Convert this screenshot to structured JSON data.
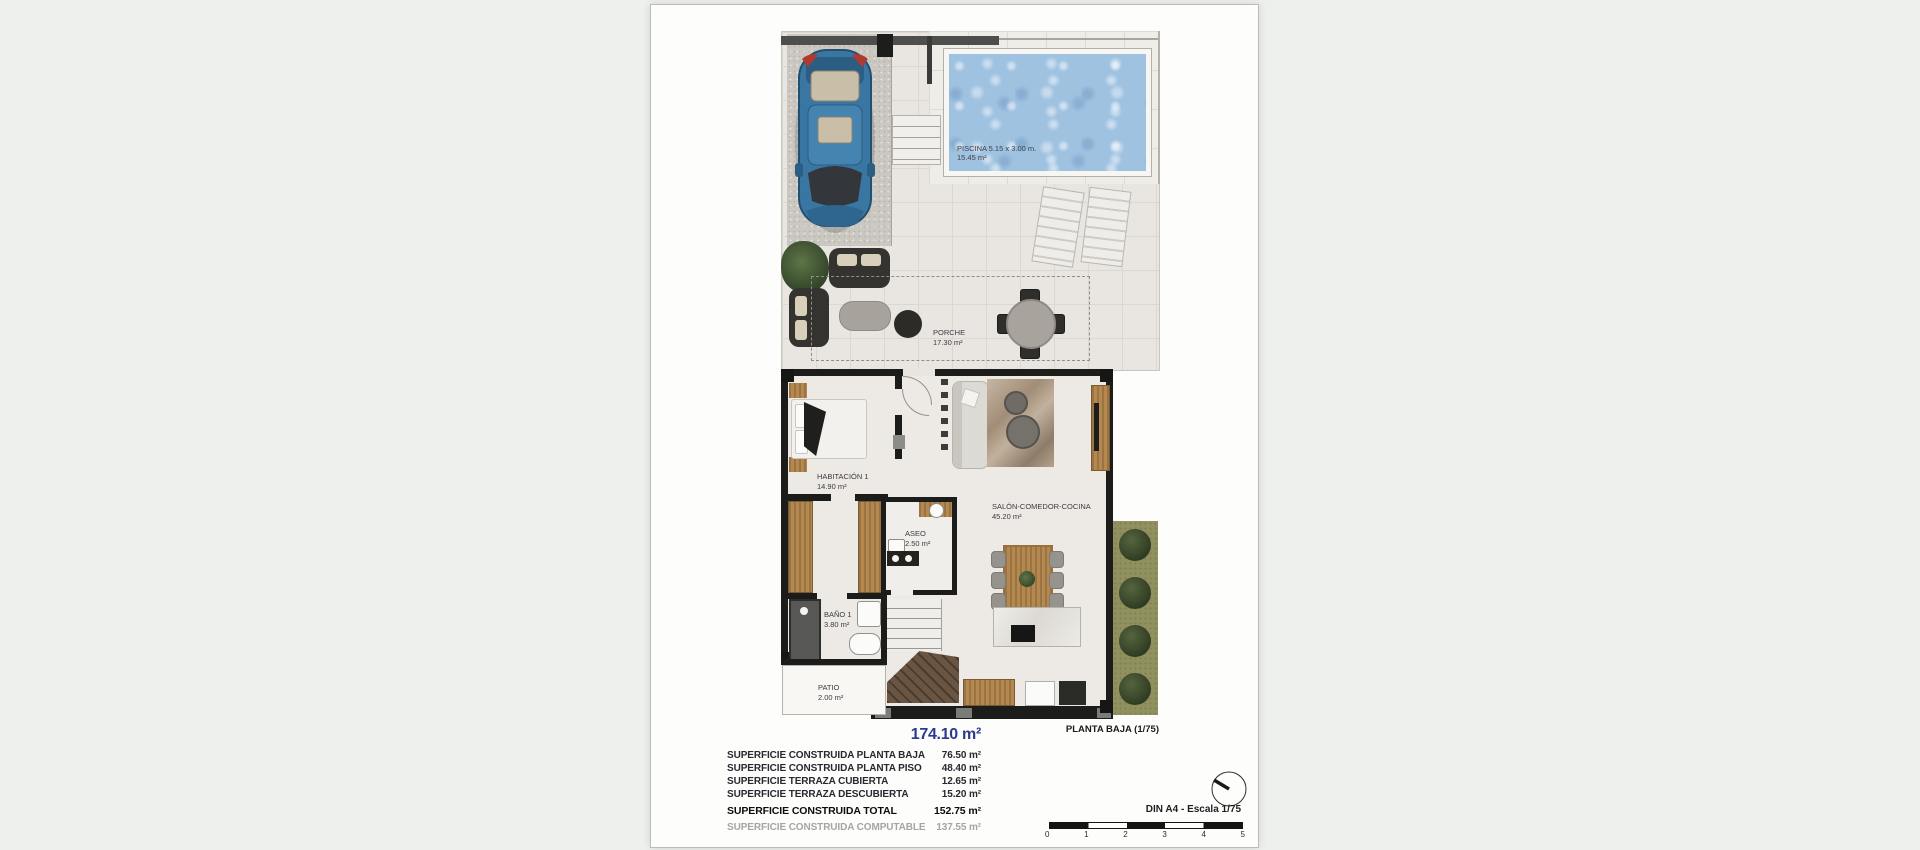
{
  "doc": {
    "plan_caption": "PLANTA BAJA (1/75)",
    "rooms": {
      "piscina": {
        "name": "PISCINA 5.15 x 3.00 m.",
        "area": "15.45 m²"
      },
      "porche": {
        "name": "PORCHE",
        "area": "17.30 m²"
      },
      "habitacion": {
        "name": "HABITACIÓN 1",
        "area": "14.90 m²"
      },
      "salon": {
        "name": "SALÓN-COMEDOR-COCINA",
        "area": "45.20 m²"
      },
      "aseo": {
        "name": "ASEO",
        "area": "2.50 m²"
      },
      "bano": {
        "name": "BAÑO 1",
        "area": "3.80 m²"
      },
      "patio": {
        "name": "PATIO",
        "area": "2.00 m²"
      }
    },
    "summary": {
      "title": "174.10 m²",
      "rows": [
        {
          "label": "SUPERFICIE CONSTRUIDA PLANTA BAJA",
          "value": "76.50 m²"
        },
        {
          "label": "SUPERFICIE CONSTRUIDA PLANTA PISO",
          "value": "48.40 m²"
        },
        {
          "label": "SUPERFICIE TERRAZA CUBIERTA",
          "value": "12.65 m²"
        },
        {
          "label": "SUPERFICIE TERRAZA DESCUBIERTA",
          "value": "15.20 m²"
        },
        {
          "label": "SUPERFICIE CONSTRUIDA TOTAL",
          "value": "152.75 m²"
        },
        {
          "label": "SUPERFICIE CONSTRUIDA COMPUTABLE",
          "value": "137.55 m²"
        }
      ]
    },
    "scale": {
      "label": "DIN A4 - Escala 1/75",
      "ticks": [
        "0",
        "1",
        "2",
        "3",
        "4",
        "5"
      ]
    },
    "colors": {
      "accent_blue": "#2b3a8c",
      "wall_black": "#1c1c1b",
      "pool_water": "#9fc2e1",
      "muted_gray": "#a5a5a5"
    }
  }
}
